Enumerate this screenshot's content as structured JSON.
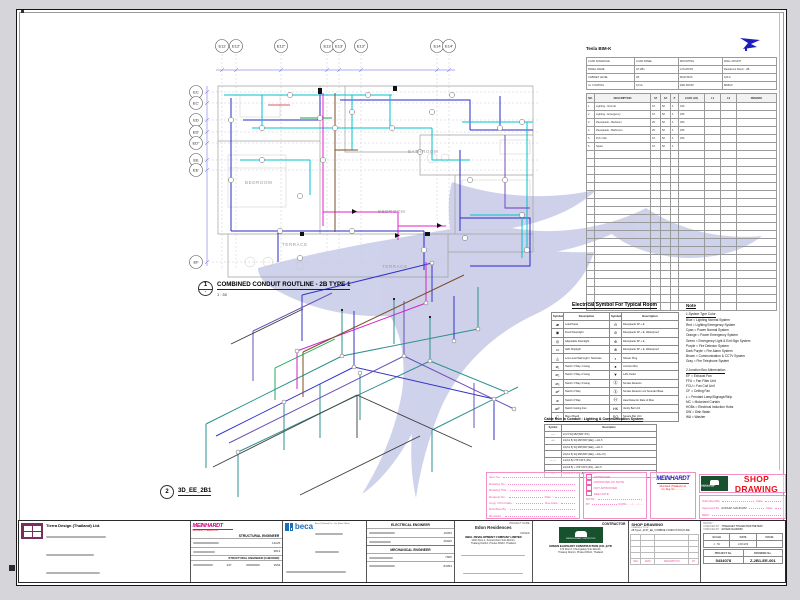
{
  "ui_colors": {
    "stamp_pink": "#f457a8",
    "shop_red": "#e8111a",
    "meinhardt_blue": "#241fb0",
    "meinhardt_magenta": "#c4007a",
    "beca_blue": "#1b6db5",
    "green_logo": "#17512e",
    "watermark": "#c7cae8"
  },
  "plan": {
    "no": "1",
    "sub": "-",
    "title": "COMBINED CONDUIT ROUTLINE - 2B TYPE 1",
    "scale": "1 : 50",
    "top_grid": [
      "E12",
      "E12'",
      "E12\"",
      "E13",
      "E13'",
      "E13\"",
      "E14",
      "E14'"
    ],
    "left_grid": [
      "EC",
      "EC'",
      "ED",
      "ED'",
      "ED\"",
      "EE",
      "EE'",
      "EF"
    ],
    "rooms": {
      "bathroom": "BATHROOM",
      "bedroom_left": "BEDROOM",
      "bedroom_right": "BEDROOM",
      "terrace_left": "TERRACE",
      "terrace_right": "TERRACE"
    }
  },
  "iso": {
    "no": "2",
    "title": "3D_EE_2B1"
  },
  "schedule": {
    "title": "Tesla BIM-K",
    "meta": [
      [
        "LOAD SCHEDULE",
        "LOAD PANEL",
        "MOUNTING",
        "WALL MOUNT"
      ],
      [
        "PANEL NAME",
        "LP-2B1",
        "LOCATION",
        "Residence Room - 2B"
      ],
      [
        "CABINET LEVEL",
        "1B",
        "MAIN BUS",
        "100 A"
      ],
      [
        "A.I.C RATING",
        "10 kA",
        "FED FROM",
        "MDB-R"
      ]
    ],
    "columns": [
      "NO.",
      "DESCRIPTION",
      "AT",
      "AF",
      "P",
      "LOAD (VA)",
      "L1",
      "L2",
      "REMARK"
    ],
    "rows": [
      [
        "1",
        "Lighting - Normal",
        "16",
        "50",
        "1",
        "420",
        "",
        "",
        ""
      ],
      [
        "2",
        "Lighting - Emergency",
        "16",
        "50",
        "1",
        "180",
        "",
        "",
        ""
      ],
      [
        "3",
        "Receptacle - Bedroom",
        "20",
        "50",
        "1",
        "360",
        "",
        "",
        ""
      ],
      [
        "4",
        "Receptacle - Bathroom",
        "20",
        "50",
        "1",
        "180",
        "",
        "",
        ""
      ],
      [
        "5",
        "FCU / EF",
        "16",
        "50",
        "1",
        "250",
        "",
        "",
        ""
      ],
      [
        "6",
        "Spare",
        "16",
        "50",
        "1",
        "",
        "",
        "",
        ""
      ],
      [
        "",
        "",
        "",
        "",
        "",
        "",
        "",
        "",
        ""
      ],
      [
        "",
        "",
        "",
        "",
        "",
        "",
        "",
        "",
        ""
      ],
      [
        "",
        "",
        "",
        "",
        "",
        "",
        "",
        "",
        ""
      ],
      [
        "",
        "",
        "",
        "",
        "",
        "",
        "",
        "",
        ""
      ],
      [
        "",
        "",
        "",
        "",
        "",
        "",
        "",
        "",
        ""
      ],
      [
        "",
        "",
        "",
        "",
        "",
        "",
        "",
        "",
        ""
      ],
      [
        "",
        "",
        "",
        "",
        "",
        "",
        "",
        "",
        ""
      ],
      [
        "",
        "",
        "",
        "",
        "",
        "",
        "",
        "",
        ""
      ],
      [
        "",
        "",
        "",
        "",
        "",
        "",
        "",
        "",
        ""
      ],
      [
        "",
        "",
        "",
        "",
        "",
        "",
        "",
        "",
        ""
      ],
      [
        "",
        "",
        "",
        "",
        "",
        "",
        "",
        "",
        ""
      ],
      [
        "",
        "",
        "",
        "",
        "",
        "",
        "",
        "",
        ""
      ],
      [
        "",
        "",
        "",
        "",
        "",
        "",
        "",
        "",
        ""
      ],
      [
        "",
        "",
        "",
        "",
        "",
        "",
        "",
        "",
        ""
      ],
      [
        "",
        "",
        "",
        "",
        "",
        "",
        "",
        "",
        ""
      ],
      [
        "",
        "",
        "",
        "",
        "",
        "",
        "",
        "",
        ""
      ],
      [
        "",
        "",
        "",
        "",
        "",
        "",
        "",
        "",
        ""
      ],
      [
        "",
        "",
        "",
        "",
        "",
        "",
        "",
        "",
        ""
      ],
      [
        "",
        "",
        "",
        "",
        "",
        "",
        "",
        "",
        ""
      ],
      [
        "",
        "",
        "",
        "",
        "",
        "",
        "",
        "",
        ""
      ]
    ]
  },
  "legend": {
    "title": "Electrical Symbol For Typical Room",
    "headers": [
      "Symbol",
      "Description",
      "Symbol",
      "Description"
    ],
    "rows": [
      [
        "▰",
        "Load Panel",
        "⊖",
        "Receptacle 2P + E"
      ],
      [
        "◉",
        "Fixed Downlight",
        "⊘",
        "Receptacle 2P + E, Waterproof"
      ],
      [
        "◎",
        "Adjustable Downlight",
        "⊕",
        "Receptacle 3P + E"
      ],
      [
        "▭",
        "LED Striplight",
        "⊗",
        "Receptacle 3P + E, Waterproof"
      ],
      [
        "◬",
        "Low Level Wall Light / Staircase",
        "◐",
        "Shaver Plug"
      ],
      [
        "⌀₁",
        "Switch 1 Way 1 Gang",
        "●",
        "Junction Box"
      ],
      [
        "⌀₂",
        "Switch 1 Way 2 Gang",
        "▼",
        "LAN Outlet"
      ],
      [
        "⌀₃",
        "Switch 1 Way 3 Gang",
        "Ⓢ",
        "Smoke Detector"
      ],
      [
        "⌀²",
        "Switch 2 Way",
        "Ⓢ",
        "Smoke Detector c/w Sounder Base"
      ],
      [
        "⌀",
        "Switch 2 Way",
        "Ⓗ",
        "Heat Detector Rate of Rise"
      ],
      [
        "⌀F",
        "Switch Ceiling Fan",
        "HK",
        "Vanity Bar Unit"
      ],
      [
        "▯",
        "Menu Board",
        "SQ",
        "Square Bar Unit"
      ]
    ]
  },
  "cable": {
    "title": "Cable Run In Conduit : Lighting & Communication System",
    "headers": [
      "Symbol",
      "Description"
    ],
    "rows": [
      [
        "──",
        "2x1.5 SQ.MM (BAT, IPC)"
      ],
      [
        "─/─",
        "2x(2x1.5) SQ.MM (BAT (EE)), +1x1.5"
      ],
      [
        "",
        "2x(2x1.5) SQ.MM (BAT (EE)), +4x1.5"
      ],
      [
        "",
        "2x(2x1.5) SQ.MM (BAT (EE)), +4(1+1.5)"
      ],
      [
        "─···─",
        "1x(2x1.5) UTP CAT.6 (FG)"
      ],
      [
        "",
        "2x(2x0.5) + UTP CAT.6 (FG), +4x1.5"
      ],
      [
        "─//─",
        "2x(2x0.5) + UTP (BAT), +1x0.5"
      ]
    ]
  },
  "notes": {
    "title": "Note",
    "s1": "1.System Type Color",
    "colors": [
      "Blue = Lighting Normal System",
      "Red = Lighting Emergency System",
      "Cyan = Power Normal System",
      "Orange = Power Emergency System",
      "Green = Emergency Light & Exit Sign System",
      "Purple = Fire Detector System",
      "Dark Purple = Fire Alarm System",
      "Brown = Communication & CCTV System",
      "Gray = Fire Telephone System"
    ],
    "s2": "2.Junction Box Abbreviation",
    "abbr": [
      "EF = Exhaust Fan",
      "FFU = Fan Filter Unit",
      "FCU = Fan Coil Unit",
      "CF = Ceiling Fan",
      "L = Pendant Lamp/Signage/Strip",
      "MC = Motorized Curtain",
      "HOBs = Electrical Induction Hobs",
      "DW = Dish Wash",
      "WA = Washer"
    ]
  },
  "stamp": {
    "fields": {
      "item_no": "Item No :",
      "drawing_no": "Drawing No :",
      "drawing_title": "Drawing Title :",
      "request_no": "Request No :",
      "date": "Date :",
      "copy_print": "Copy / Print Date :",
      "due_date": "Due Date :",
      "distribute_by": "Distribute By :",
      "remarks": "Remarks :"
    },
    "checks": [
      "APPROVED",
      "APPROVED AS NOTE",
      "NOT APPROVED",
      "SEE NOTE"
    ],
    "note_label": "NOTE :",
    "by_label": "BY",
    "date_label": "DATE",
    "date_slots": "....../....../......",
    "meinhardt": "MEINHARDT",
    "meinhardt_sub1": "Meinhardt (Thailand) Ltd.",
    "meinhardt_sub2": "Co. Reg. No. .............",
    "shop_drawing": "SHOP DRAWING",
    "submitted_by": "Submitted By",
    "approved_by": "Approved By",
    "approved_name": "AOISAK NAUDOM",
    "rem": "REM :",
    "date2": "Date"
  },
  "titleblock": {
    "architect": {
      "company": "Tierra Design (Thailand) Ltd.",
      "role": "ARCHITECT",
      "role2": "LANDSCAPE ARCHITECT",
      "lic": [
        "2560",
        "8055",
        "10120",
        "10577"
      ],
      "lic2": [
        "20162",
        "134"
      ]
    },
    "structural": {
      "logo": "MEINHARDT",
      "sub": "Meinhardt (Thailand) Ltd.",
      "role": "STRUCTURAL ENGINEER",
      "role2": "STRUCTURAL ENGINEER (CHECKER)",
      "lic": [
        "13225",
        "9813"
      ],
      "lic2": [
        "337",
        "2953"
      ]
    },
    "sanitary": {
      "logo": "beca",
      "sub": "Beca (Thailand) Co., Ltd. (Head Office)",
      "role": "SANITARY ENGINEER",
      "lic": [
        "552",
        "2953"
      ]
    },
    "electrical": {
      "role": "ELECTRICAL ENGINEER",
      "lic": [
        "19453",
        "29026"
      ]
    },
    "mechanical": {
      "role": "MECHANICAL ENGINEER",
      "lic": [
        "7906",
        "84094"
      ]
    },
    "project": {
      "label": "PROJECT NAME",
      "name": "Edon Residences",
      "owner_label": "OWNER",
      "owner": "AWAL DEVELOPMENT COMPANY LIMITED",
      "addr1": "149/1 Moo 4, Srisoonthorn Sub-District,",
      "addr2": "Thalang District, Phuket 83110, Thailand"
    },
    "contractor": {
      "label": "CONTRACTOR",
      "name": "GREEN ELEPHANT CONSTRUCTION (CO.,)LTD",
      "addr1": "179 Moo 8, Cherngtalay Sub-District,",
      "addr2": "Thalang District, Phuket 83110, Thailand",
      "logo_text": "GREEN ELEPHANT CONSTRUCTION"
    },
    "shopdrawing": {
      "label": "SHOP DRAWING",
      "drawing_title_label": "DRAWING TITLE :",
      "drawing_title": "2B Type1_21ST_EE_COMBINE CONDUIT ROUTLINE",
      "rev_headers": [
        "REV",
        "DATE",
        "DESCRIPTION",
        "BY"
      ],
      "drn_label": "DRN BY :",
      "checked_label": "CHECKED BY :",
      "checked1": "THANAGET THANACHOKTHETRAT",
      "checked2": "AOISAK NAUDOM",
      "scale_label": "SCALE",
      "scale": "1 : 50",
      "date_label": "DATE",
      "date": "24/04/09",
      "issue_label": "ISSUE",
      "project_no_label": "PROJECT No.",
      "project_no": "5434078",
      "drawing_no_label": "DRAWING No.",
      "drawing_no": "Z-2B1-EE-001"
    }
  }
}
